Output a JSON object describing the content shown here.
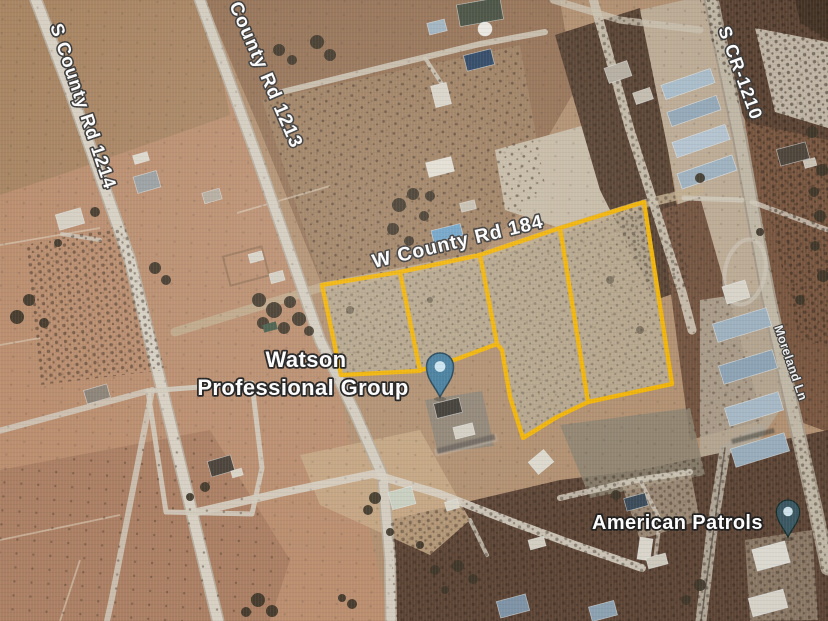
{
  "road_labels": [
    {
      "id": "s-county-rd-1214",
      "text": "S County Rd 1214"
    },
    {
      "id": "county-rd-1213",
      "text": "County Rd 1213"
    },
    {
      "id": "s-cr-1210",
      "text": "S CR-1210"
    },
    {
      "id": "w-county-rd-184",
      "text": "W County Rd 184"
    },
    {
      "id": "moreland-ln",
      "text": "Moreland Ln"
    }
  ],
  "places": {
    "watson": {
      "line1": "Watson",
      "line2": "Professional Group"
    },
    "american_patrols": {
      "text": "American Patrols"
    }
  },
  "markers": [
    {
      "name": "watson-professional-group-pin",
      "color": "#457e9e",
      "inner": "#c9e4f0"
    },
    {
      "name": "american-patrols-pin",
      "color": "#3a5862",
      "inner": "#cfe3ea"
    }
  ],
  "parcels": {
    "outlined_count": 4,
    "outline_color": "#f3b402"
  }
}
